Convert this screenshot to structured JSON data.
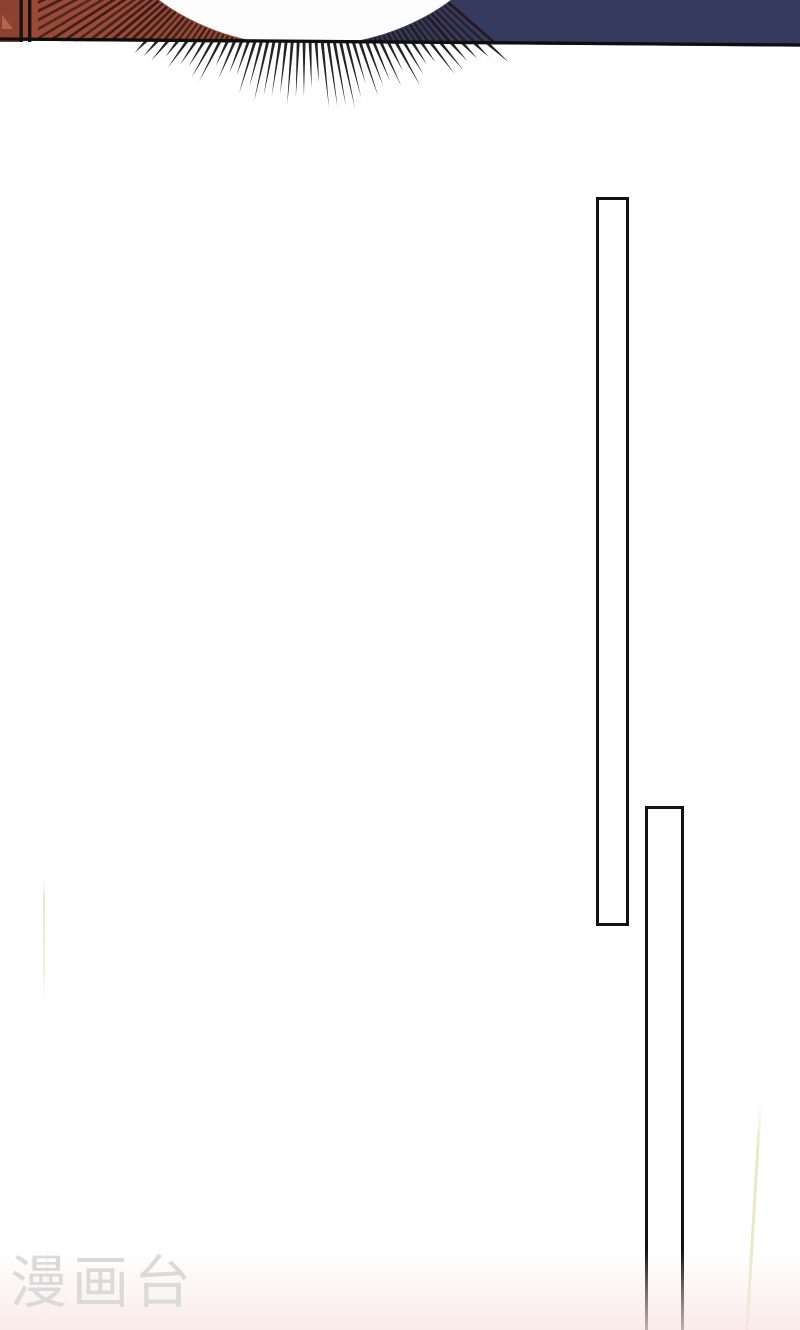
{
  "page": {
    "type": "comic-page-scroll-view",
    "background": "#ffffff"
  },
  "watermark": {
    "text": "漫画台",
    "color": "#dadada"
  },
  "top_panel": {
    "red": "#9a4a36",
    "red_dark_block": "#8d4130",
    "red_notch": "#b4664a",
    "navy": "#343b5e",
    "border_line": "#0e0e0e",
    "glow_white": "#fdfdfe",
    "hatch_line": "#241512",
    "spike_black": "#101010",
    "divider_black": "#141414"
  },
  "scratches": {
    "color": "#ece9c8"
  },
  "bottom_tint_color": "#f7e4e0"
}
